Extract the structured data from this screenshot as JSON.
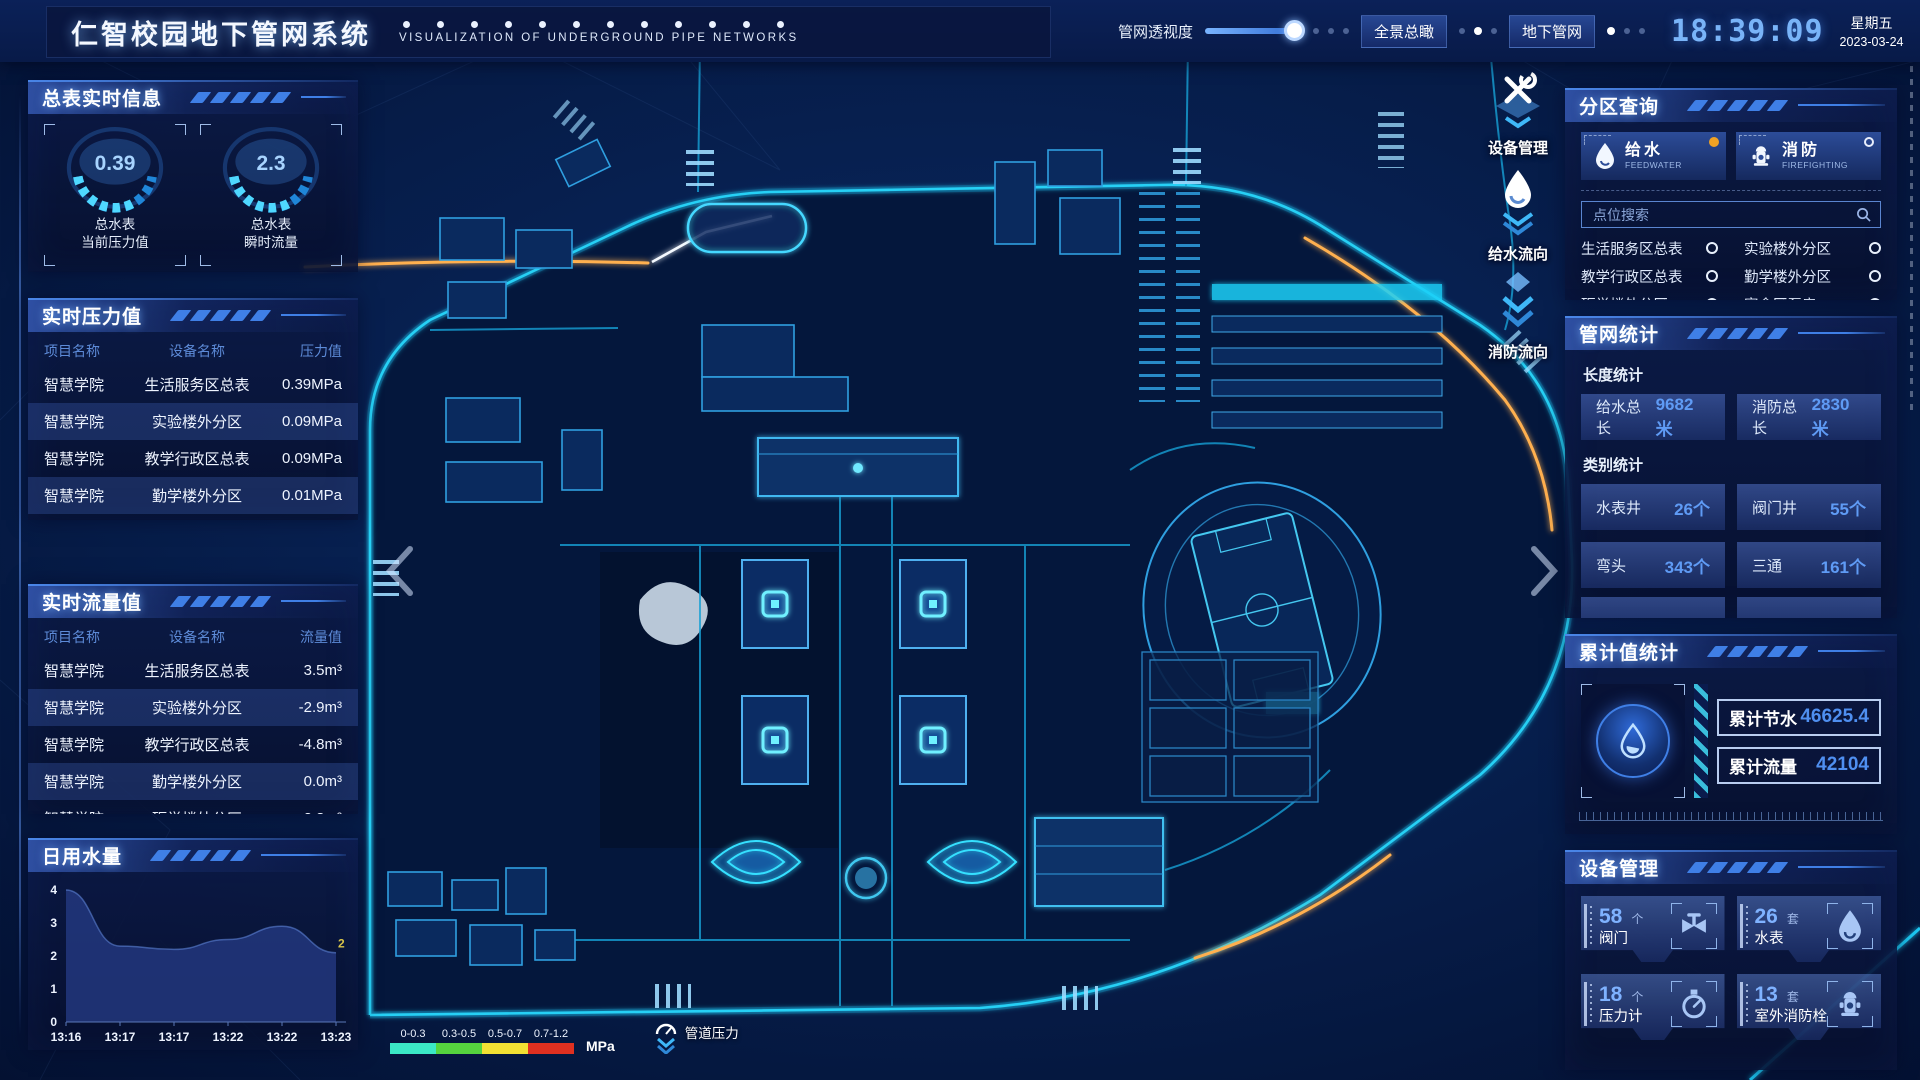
{
  "header": {
    "title": "仁智校园地下管网系统",
    "subtitle": "VISUALIZATION OF UNDERGROUND PIPE NETWORKS",
    "slider_label": "管网透视度",
    "buttons": [
      "全景总瞰",
      "地下管网"
    ],
    "time": "18:39:09",
    "weekday": "星期五",
    "date": "2023-03-24"
  },
  "left": {
    "meter_panel": {
      "title": "总表实时信息",
      "gauges": [
        {
          "value": "0.39",
          "label1": "总水表",
          "label2": "当前压力值"
        },
        {
          "value": "2.3",
          "label1": "总水表",
          "label2": "瞬时流量"
        }
      ]
    },
    "pressure_panel": {
      "title": "实时压力值",
      "columns": [
        "项目名称",
        "设备名称",
        "压力值"
      ],
      "rows": [
        [
          "智慧学院",
          "生活服务区总表",
          "0.39MPa"
        ],
        [
          "智慧学院",
          "实验楼外分区",
          "0.09MPa"
        ],
        [
          "智慧学院",
          "教学行政区总表",
          "0.09MPa"
        ],
        [
          "智慧学院",
          "勤学楼外分区",
          "0.01MPa"
        ],
        [
          "智慧学院",
          "砺学楼外分区",
          "0.00MPa"
        ]
      ]
    },
    "flow_panel": {
      "title": "实时流量值",
      "columns": [
        "项目名称",
        "设备名称",
        "流量值"
      ],
      "rows": [
        [
          "智慧学院",
          "生活服务区总表",
          "3.5m³"
        ],
        [
          "智慧学院",
          "实验楼外分区",
          "-2.9m³"
        ],
        [
          "智慧学院",
          "教学行政区总表",
          "-4.8m³"
        ],
        [
          "智慧学院",
          "勤学楼外分区",
          "0.0m³"
        ],
        [
          "智慧学院",
          "砺学楼外分区",
          "2.3m³"
        ]
      ]
    },
    "daily_panel": {
      "title": "日用水量"
    }
  },
  "chart_data": {
    "type": "area",
    "title": "日用水量",
    "x": [
      "13:16",
      "13:17",
      "13:17",
      "13:22",
      "13:22",
      "13:23"
    ],
    "values": [
      4,
      2.3,
      2.2,
      2.5,
      2.9,
      2.1
    ],
    "ylim": [
      0,
      4
    ],
    "yticks": [
      0,
      1,
      2,
      3,
      4
    ],
    "end_label": "2",
    "grid": false,
    "legend_position": "none"
  },
  "right": {
    "query_panel": {
      "title": "分区查询",
      "tabs": [
        {
          "label": "给水",
          "sub": "FEEDWATER",
          "icon": "water-drop-icon",
          "selected": true
        },
        {
          "label": "消防",
          "sub": "FIREFIGHTING",
          "icon": "hydrant-icon",
          "selected": false
        }
      ],
      "search_placeholder": "点位搜索",
      "items": [
        "生活服务区总表",
        "实验楼外分区",
        "教学行政区总表",
        "勤学楼外分区",
        "砺学楼外分区",
        "宿舍区泵房"
      ]
    },
    "stats_panel": {
      "title": "管网统计",
      "length_label": "长度统计",
      "length_stats": [
        {
          "label": "给水总长",
          "value": "9682米"
        },
        {
          "label": "消防总长",
          "value": "2830米"
        }
      ],
      "category_label": "类别统计",
      "category_stats": [
        {
          "label": "水表井",
          "value": "26个"
        },
        {
          "label": "阀门井",
          "value": "55个"
        },
        {
          "label": "弯头",
          "value": "343个"
        },
        {
          "label": "三通",
          "value": "161个"
        }
      ]
    },
    "total_panel": {
      "title": "累计值统计",
      "rows": [
        {
          "label": "累计节水",
          "value": "46625.4"
        },
        {
          "label": "累计流量",
          "value": "42104"
        }
      ]
    },
    "device_panel": {
      "title": "设备管理",
      "cards": [
        {
          "count": "58",
          "unit": "个",
          "label": "阀门",
          "icon": "valve-icon"
        },
        {
          "count": "26",
          "unit": "套",
          "label": "水表",
          "icon": "water-meter-icon"
        },
        {
          "count": "18",
          "unit": "个",
          "label": "压力计",
          "icon": "pressure-gauge-icon"
        },
        {
          "count": "13",
          "unit": "套",
          "label": "室外消防栓",
          "icon": "hydrant-icon"
        }
      ]
    }
  },
  "map": {
    "tools": [
      {
        "label": "设备管理",
        "icon": "wrench-icon"
      },
      {
        "label": "给水流向",
        "icon": "water-drop-icon"
      },
      {
        "label": "消防流向",
        "icon": "fire-flow-icon"
      }
    ],
    "legend": {
      "ranges": [
        "0-0.3",
        "0.3-0.5",
        "0.5-0.7",
        "0.7-1.2"
      ],
      "colors": [
        "#3be8c6",
        "#55d33e",
        "#f2e033",
        "#e03020"
      ],
      "unit": "MPa",
      "toggle_label": "管道压力"
    }
  }
}
